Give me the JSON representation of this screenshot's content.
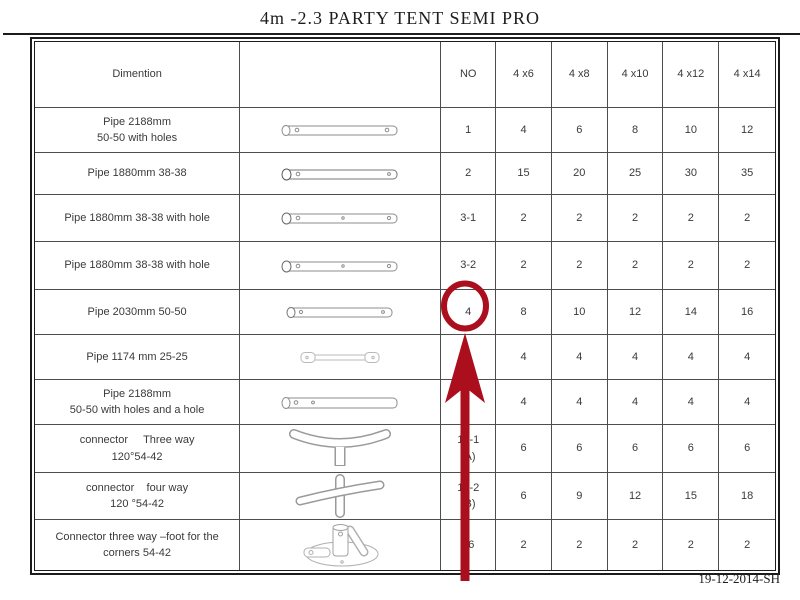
{
  "page": {
    "title": "4m -2.3 PARTY TENT SEMI PRO",
    "date_stamp": "19-12-2014-SH"
  },
  "table": {
    "headers": {
      "dimension": "Dimention",
      "no": "NO",
      "sizes": [
        "4 x6",
        "4 x8",
        "4 x10",
        "4 x12",
        "4 x14"
      ]
    },
    "rows": [
      {
        "dimension": "Pipe 2188mm\n50-50 with holes",
        "icon": "pipe-with-holes-icon",
        "no": "1",
        "values": [
          "4",
          "6",
          "8",
          "10",
          "12"
        ]
      },
      {
        "dimension": "Pipe 1880mm 38-38",
        "icon": "pipe-plain-icon",
        "no": "2",
        "values": [
          "15",
          "20",
          "25",
          "30",
          "35"
        ]
      },
      {
        "dimension": "Pipe 1880mm 38-38 with hole",
        "icon": "pipe-with-hole-icon",
        "no": "3-1",
        "values": [
          "2",
          "2",
          "2",
          "2",
          "2"
        ]
      },
      {
        "dimension": "Pipe 1880mm 38-38 with hole",
        "icon": "pipe-with-hole-icon",
        "no": "3-2",
        "values": [
          "2",
          "2",
          "2",
          "2",
          "2"
        ]
      },
      {
        "dimension": "Pipe 2030mm 50-50",
        "icon": "pipe-with-hole-icon",
        "no": "4",
        "values": [
          "8",
          "10",
          "12",
          "14",
          "16"
        ]
      },
      {
        "dimension": "Pipe 1174 mm 25-25",
        "icon": "short-pipe-icon",
        "no": "",
        "values": [
          "4",
          "4",
          "4",
          "4",
          "4"
        ]
      },
      {
        "dimension": "Pipe 2188mm\n50-50 with holes and a hole",
        "icon": "pipe-with-holes-and-hole-icon",
        "no": "",
        "values": [
          "4",
          "4",
          "4",
          "4",
          "4"
        ]
      },
      {
        "dimension": "connector     Three way\n120°54-42",
        "icon": "three-way-connector-icon",
        "no": "15-1\n(A)",
        "values": [
          "6",
          "6",
          "6",
          "6",
          "6"
        ]
      },
      {
        "dimension": "connector    four way\n120 °54-42",
        "icon": "four-way-connector-icon",
        "no": "15-2\n(B)",
        "values": [
          "6",
          "9",
          "12",
          "15",
          "18"
        ]
      },
      {
        "dimension": "Connector three way –foot for the\ncorners 54-42",
        "icon": "foot-connector-icon",
        "no": "16",
        "values": [
          "2",
          "2",
          "2",
          "2",
          "2"
        ]
      }
    ]
  },
  "annotation": {
    "color": "#ab0f1e"
  }
}
